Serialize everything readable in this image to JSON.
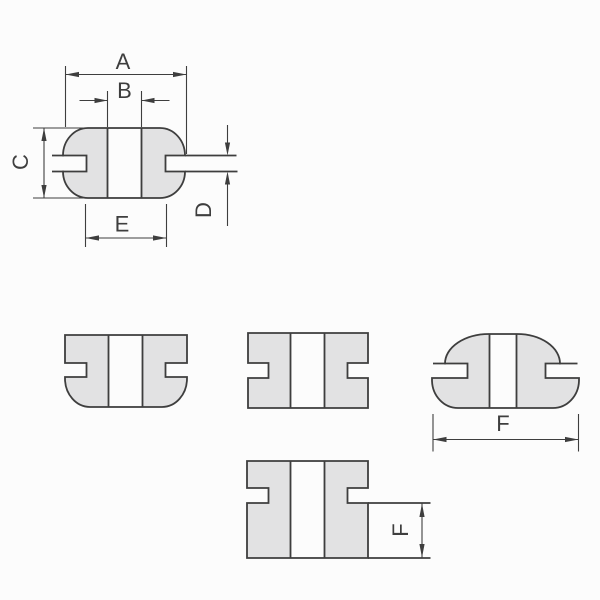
{
  "diagram": {
    "kind": "engineering cross-section drawing",
    "subject": "rubber grommet profiles with dimension callouts"
  },
  "labels": {
    "a": "A",
    "b": "B",
    "c": "C",
    "d": "D",
    "e": "E",
    "f_width": "F",
    "f_height": "F"
  },
  "colors": {
    "background": "#fcfcfc",
    "body_fill": "#e2e2e3",
    "line": "#3e3e3e"
  }
}
